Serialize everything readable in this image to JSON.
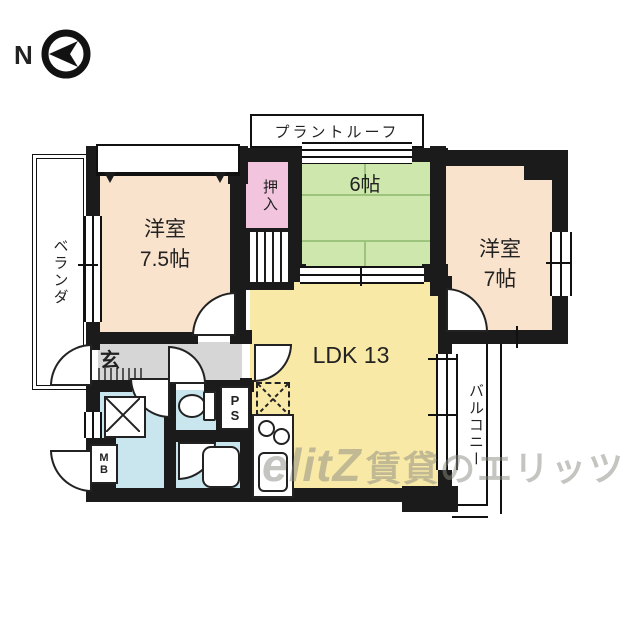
{
  "compass": {
    "label": "N",
    "icon": "compass-left-arrow-icon"
  },
  "labels": {
    "plant_roof": "プラントルーフ",
    "veranda": "ベランダ",
    "balcony": "バルコニー",
    "closet": "押入",
    "entrance": "玄",
    "ps": "PS",
    "mb": "MB"
  },
  "rooms": {
    "western_75": {
      "line1": "洋室",
      "line2": "7.5帖"
    },
    "western_7": {
      "line1": "洋室",
      "line2": "7帖"
    },
    "tatami_6": {
      "label": "6帖"
    },
    "ldk": {
      "label": "LDK 13"
    }
  },
  "watermark": {
    "logo": "elitZ",
    "text": "賃貸のエリッツ"
  },
  "colors": {
    "wall": "#1b1b1b",
    "western_room": "#fae3cd",
    "closet_pink": "#f2c4dd",
    "tatami_green": "#cde7ad",
    "ldk_yellow": "#f8e9a6",
    "hall_gray": "#d6d6d6",
    "wet_blue": "#c9e5ee"
  }
}
